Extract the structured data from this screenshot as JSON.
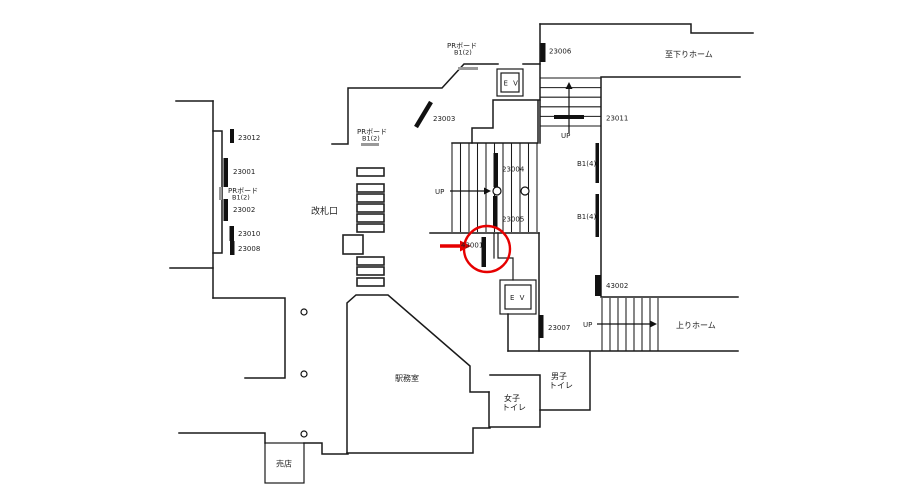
{
  "map_type": "station-floor-plan",
  "colors": {
    "wall": "#1a1a1a",
    "sign_bar": "#111111",
    "pr_board_gray": "#999999",
    "annotation_red": "#e60000"
  },
  "signs": {
    "n23012": "23012",
    "n23001": "23001",
    "n23002": "23002",
    "n23010": "23010",
    "n23008": "23008",
    "n23003": "23003",
    "n23004": "23004",
    "n23005": "23005",
    "n23006": "23006",
    "n23007": "23007",
    "n23011": "23011",
    "n43001": "43001",
    "n43002": "43002",
    "b1_4": "B1(4)"
  },
  "pr_board": {
    "line1": "PRボード",
    "line2": "B1(2)"
  },
  "labels": {
    "ticket_gate": "改札口",
    "station_office": "駅務室",
    "kiosk": "売店",
    "mens_1": "男子",
    "mens_2": "トイレ",
    "womens_1": "女子",
    "womens_2": "トイレ",
    "to_down_platform": "至下りホーム",
    "up_platform": "上りホーム",
    "up": "UP",
    "elevator": "E V"
  },
  "annotation": {
    "type": "red-circle-with-arrow",
    "target_sign": "43001",
    "color": "#e60000"
  }
}
